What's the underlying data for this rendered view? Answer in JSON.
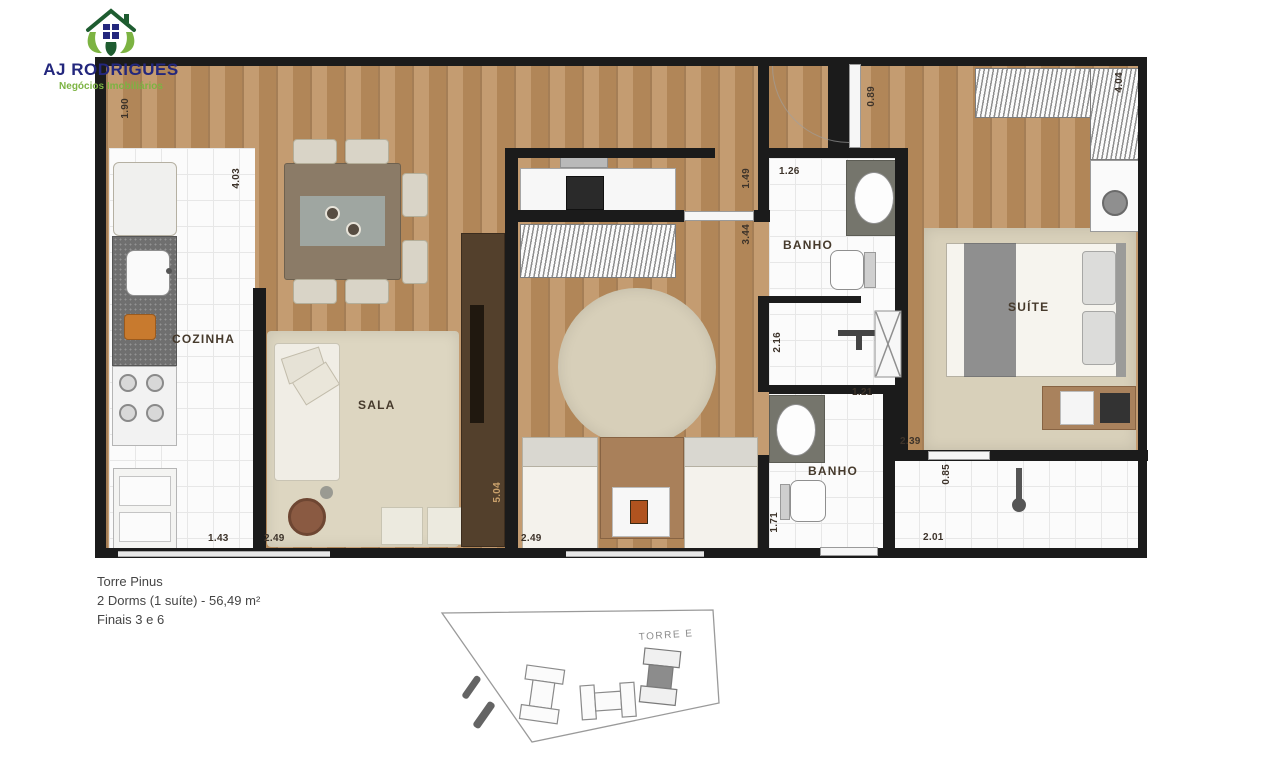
{
  "logo": {
    "company": "AJ RODRIGUES",
    "tagline": "Negócios Imobiliários"
  },
  "plan": {
    "rooms": {
      "kitchen": "COZINHA",
      "living": "SALA",
      "bath_upper": "BANHO",
      "bath_lower": "BANHO",
      "suite": "SUÍTE"
    },
    "dimensions": [
      {
        "value": "1.90"
      },
      {
        "value": "4.03"
      },
      {
        "value": "1.43"
      },
      {
        "value": "2.49"
      },
      {
        "value": "5.04"
      },
      {
        "value": "2.49"
      },
      {
        "value": "1.49"
      },
      {
        "value": "3.44"
      },
      {
        "value": "0.89"
      },
      {
        "value": "1.26"
      },
      {
        "value": "2.16"
      },
      {
        "value": "1.21"
      },
      {
        "value": "1.71"
      },
      {
        "value": "2.39"
      },
      {
        "value": "0.85"
      },
      {
        "value": "2.01"
      },
      {
        "value": "4.04"
      }
    ]
  },
  "caption": {
    "line1": "Torre Pinus",
    "line2": "2 Dorms (1 suíte) - 56,49 m²",
    "line3": "Finais 3 e 6"
  },
  "siteplan": {
    "tower_label": "TORRE E"
  },
  "colors": {
    "brand_navy": "#23277d",
    "brand_green": "#7cb342",
    "wall": "#1b1b1b",
    "wood": "#bd9161",
    "rug": "#ddd6c1",
    "granite": "#6f6f6f",
    "dimension_text": "#3d332a"
  }
}
